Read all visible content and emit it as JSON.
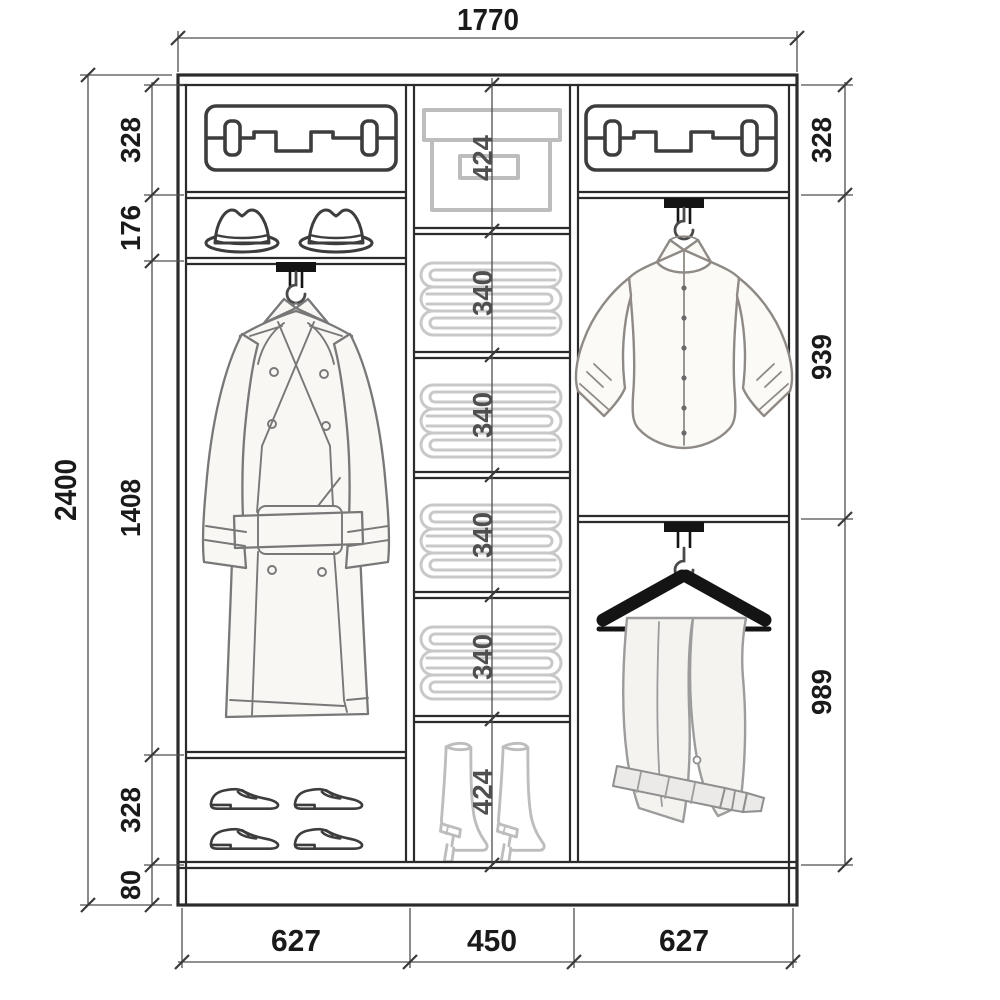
{
  "drawing": {
    "kind": "wardrobe-interior-dimension-diagram"
  },
  "dims": {
    "width_total": "1770",
    "height_total": "2400",
    "left": [
      "328",
      "176",
      "1408",
      "328",
      "80"
    ],
    "right": [
      "328",
      "939",
      "989"
    ],
    "middle": [
      "424",
      "340",
      "340",
      "340",
      "340",
      "424"
    ],
    "bottom": [
      "627",
      "450",
      "627"
    ]
  },
  "icons": {
    "left_column": [
      "suitcase-icon",
      "hats-icon",
      "coat-on-hanger-icon",
      "shoes-icon"
    ],
    "middle_column": [
      "storage-box-icon",
      "folded-linen-icon",
      "folded-linen-icon",
      "folded-linen-icon",
      "folded-linen-icon",
      "boots-icon"
    ],
    "right_column": [
      "suitcase-icon",
      "shirt-on-hanger-icon",
      "trousers-on-hanger-icon"
    ]
  },
  "colors": {
    "line": "#2b2b2b",
    "dimension": "#4d4d4d",
    "light_icon": "#bdbdbd",
    "garment_stroke": "#8a8a8a",
    "bracket": "#141414",
    "background": "#ffffff"
  }
}
